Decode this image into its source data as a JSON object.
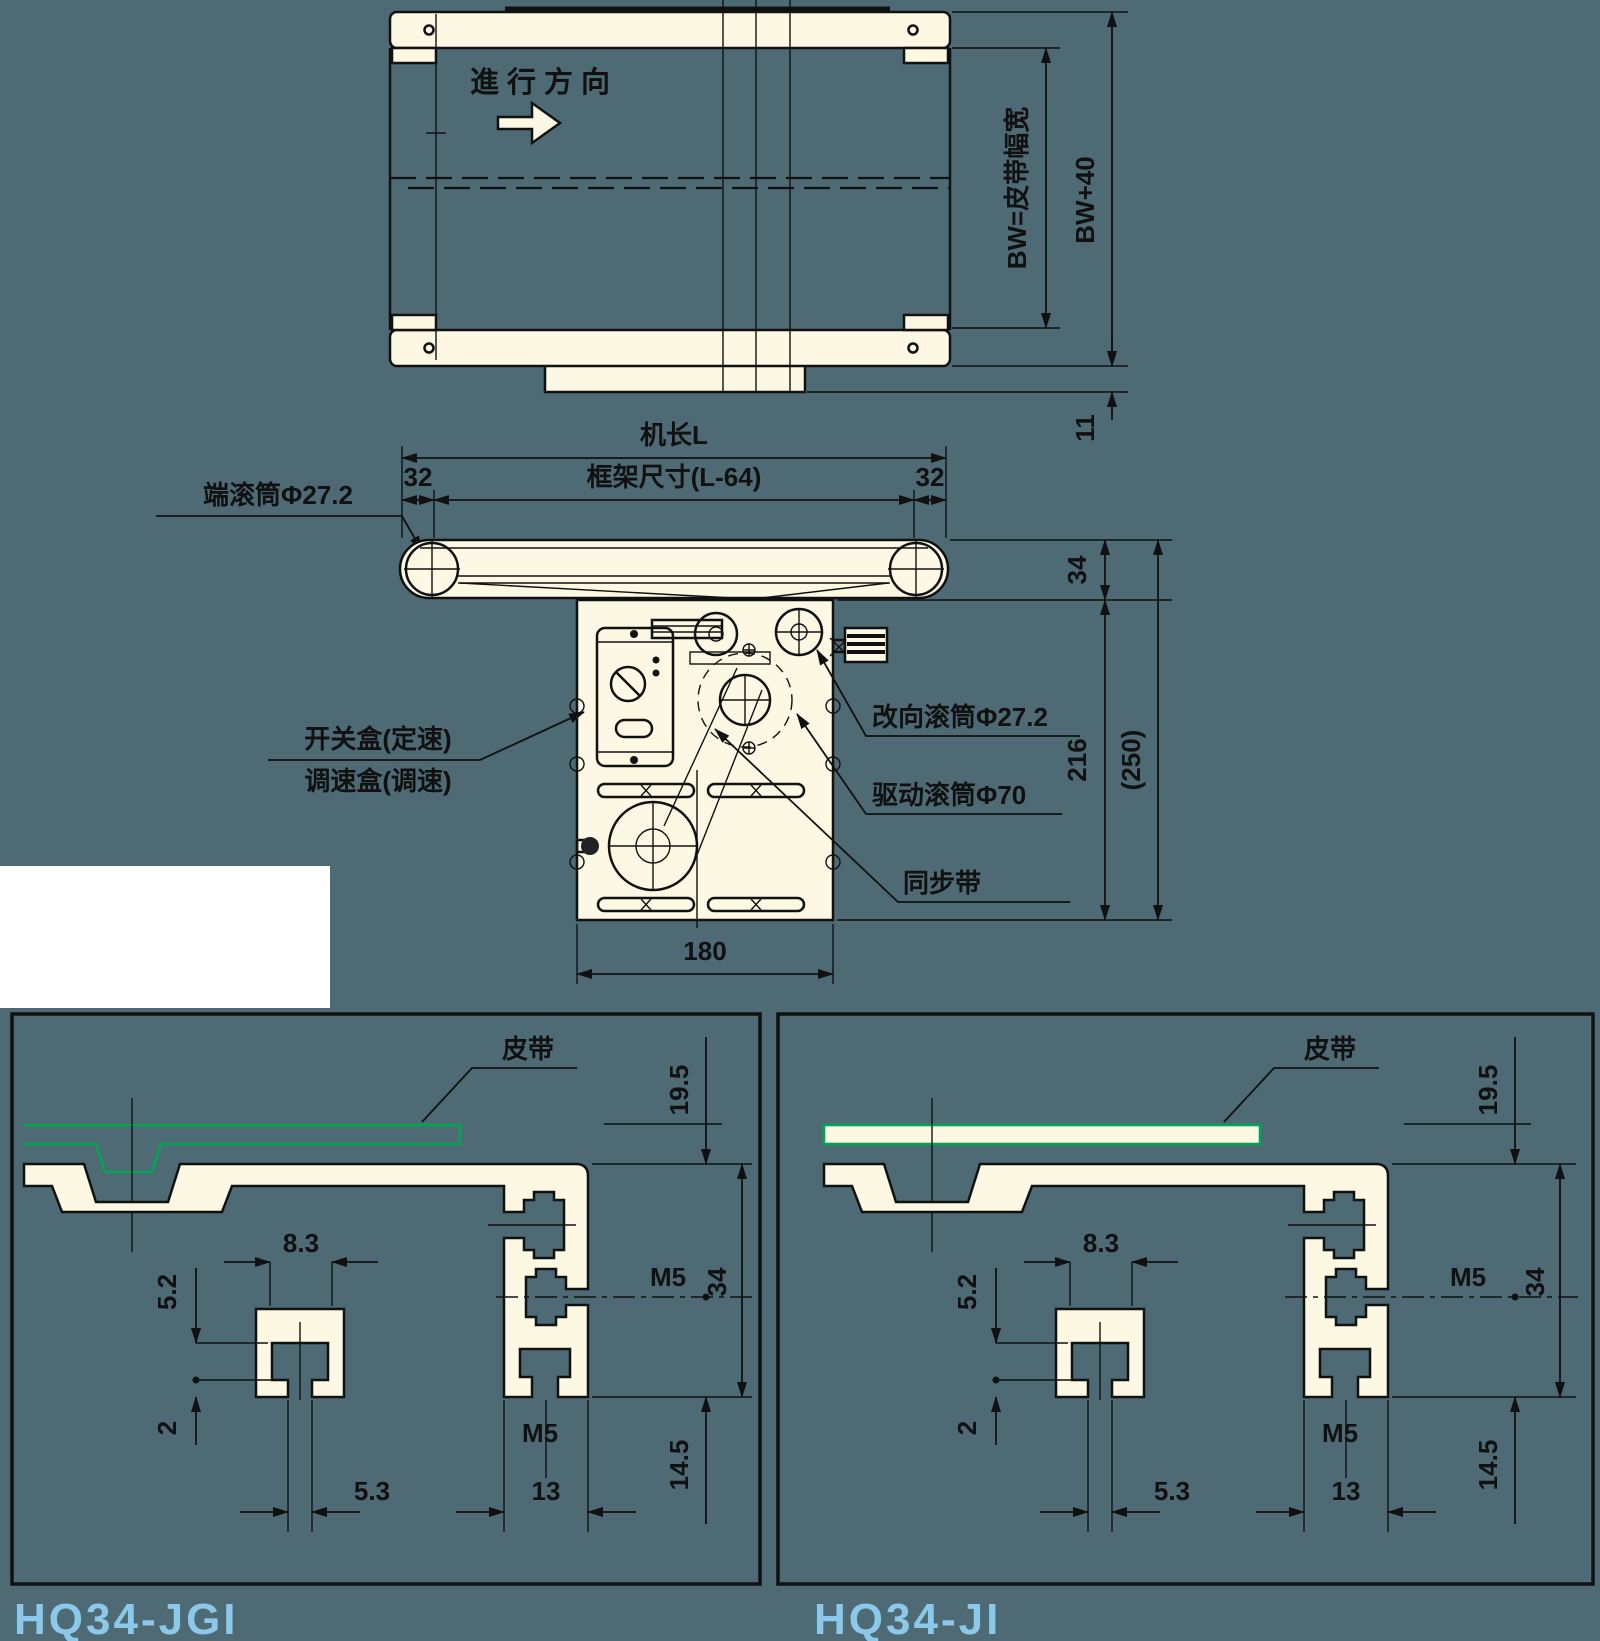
{
  "colors": {
    "background": "#4d6a75",
    "drawing_fill": "#fcf8e3",
    "line": "#111111",
    "belt_green": "#00a651",
    "model_label_blue": "#8cc8ea"
  },
  "top_view": {
    "direction_label": "進行方向",
    "dim_belt_width": "BW=皮带幅宽",
    "dim_overall_width": "BW+40",
    "dim_offset": "11"
  },
  "side_view": {
    "dim_machine_length": "机长L",
    "dim_frame_size": "框架尺寸(L-64)",
    "dim_32_left": "32",
    "dim_32_right": "32",
    "label_end_roller": "端滚筒Φ27.2",
    "label_switch_box": "开关盒(定速)",
    "label_speed_box": "调速盒(调速)",
    "label_reverse_roller": "改向滚筒Φ27.2",
    "label_drive_roller": "驱动滚筒Φ70",
    "label_timing_belt": "同步带",
    "dim_34": "34",
    "dim_216": "216",
    "dim_250": "(250)",
    "dim_180": "180"
  },
  "panels": [
    {
      "model": "HQ34-JGI",
      "belt_label": "皮带",
      "dims": {
        "d19_5": "19.5",
        "d8_3": "8.3",
        "d5_2": "5.2",
        "d2": "2",
        "d5_3": "5.3",
        "m5_side": "M5",
        "m5_bottom": "M5",
        "d34": "34",
        "d13": "13",
        "d14_5": "14.5"
      }
    },
    {
      "model": "HQ34-JI",
      "belt_label": "皮带",
      "dims": {
        "d19_5": "19.5",
        "d8_3": "8.3",
        "d5_2": "5.2",
        "d2": "2",
        "d5_3": "5.3",
        "m5_side": "M5",
        "m5_bottom": "M5",
        "d34": "34",
        "d13": "13",
        "d14_5": "14.5"
      }
    }
  ]
}
